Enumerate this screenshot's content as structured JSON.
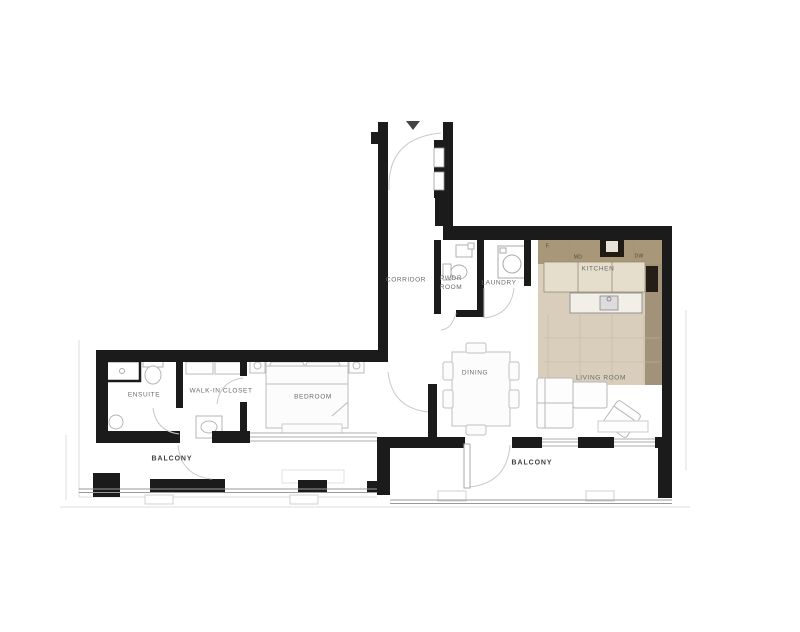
{
  "floorplan": {
    "rooms": [
      {
        "id": "corridor",
        "label": "CORRIDOR"
      },
      {
        "id": "pwdr-room",
        "label": "PWDR ROOM"
      },
      {
        "id": "laundry",
        "label": "LAUNDRY"
      },
      {
        "id": "kitchen",
        "label": "KITCHEN"
      },
      {
        "id": "dining",
        "label": "DINING"
      },
      {
        "id": "living-room",
        "label": "LIVING ROOM"
      },
      {
        "id": "ensuite",
        "label": "ENSUITE"
      },
      {
        "id": "walk-in-closet",
        "label": "WALK-IN CLOSET"
      },
      {
        "id": "bedroom",
        "label": "BEDROOM"
      },
      {
        "id": "balcony-left",
        "label": "BALCONY"
      },
      {
        "id": "balcony-right",
        "label": "BALCONY"
      }
    ],
    "appliances": [
      {
        "id": "fridge",
        "label": "F."
      },
      {
        "id": "microwave-drawer",
        "label": "MD"
      },
      {
        "id": "dishwasher",
        "label": "DW"
      }
    ],
    "colors": {
      "wall": "#1b1b1b",
      "kitchen_counter_tan": "#b3a287",
      "kitchen_floor_tan": "#d8cebb",
      "counter_top": "#e6decd",
      "island_white": "#f2efe9",
      "furniture_outline": "#b8b8b8",
      "label_gray": "#6a6a6a",
      "balcony_label": "#3f3f3f"
    }
  }
}
